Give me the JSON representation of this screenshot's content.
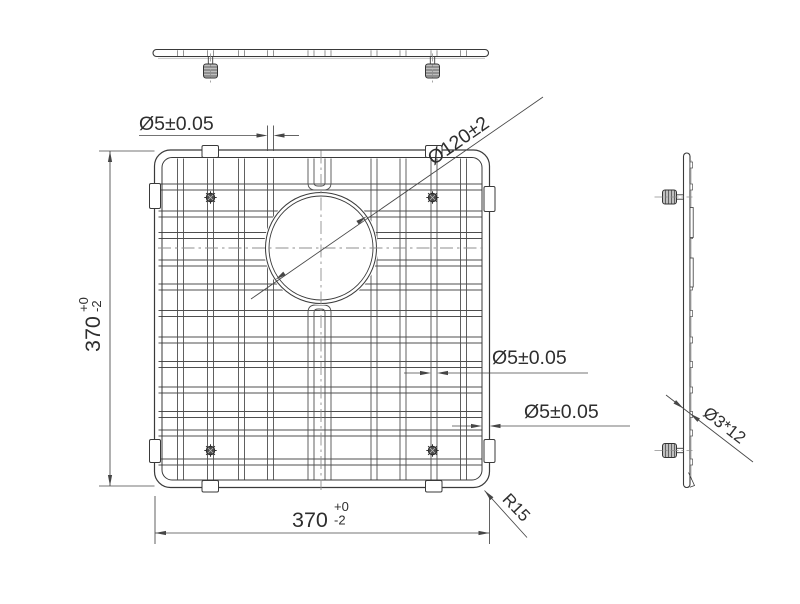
{
  "dimensions": {
    "wire_diameter_top": "Ø5±0.05",
    "hole_diameter": "Ø120±2",
    "grid_height": {
      "value": "370",
      "upper_tolerance": "+0",
      "lower_tolerance": "-2"
    },
    "wire_diameter_middle": "Ø5±0.05",
    "frame_wire_diameter": "Ø5±0.05",
    "grid_width": {
      "value": "370",
      "upper_tolerance": "+0",
      "lower_tolerance": "-2"
    },
    "corner_radius": "R15",
    "foot_spec": "Ø3*12"
  },
  "colors": {
    "background": "#ffffff",
    "line": "#3a3a3a",
    "wire": "#4f4f4f",
    "dimension_line": "#464646",
    "centerline": "#8f8f8f",
    "text": "#2e2e2e"
  }
}
